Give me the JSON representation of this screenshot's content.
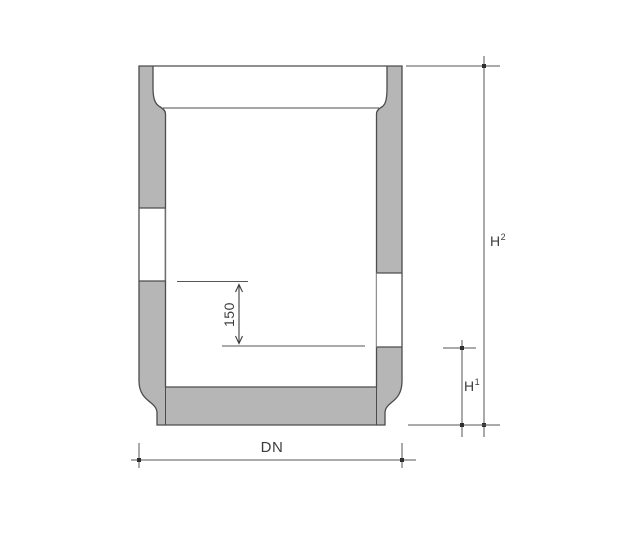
{
  "diagram": {
    "kind": "technical-cross-section",
    "labels": {
      "diameter": "DN",
      "total_height_base": "H",
      "total_height_sup": "2",
      "lower_height_base": "H",
      "lower_height_sup": "1",
      "inner_offset": "150"
    },
    "colors": {
      "background": "#ffffff",
      "concrete_fill": "#b6b6b6",
      "outline": "#4c4c4c",
      "dimension_line": "#565656",
      "text": "#3c3c3c"
    }
  }
}
